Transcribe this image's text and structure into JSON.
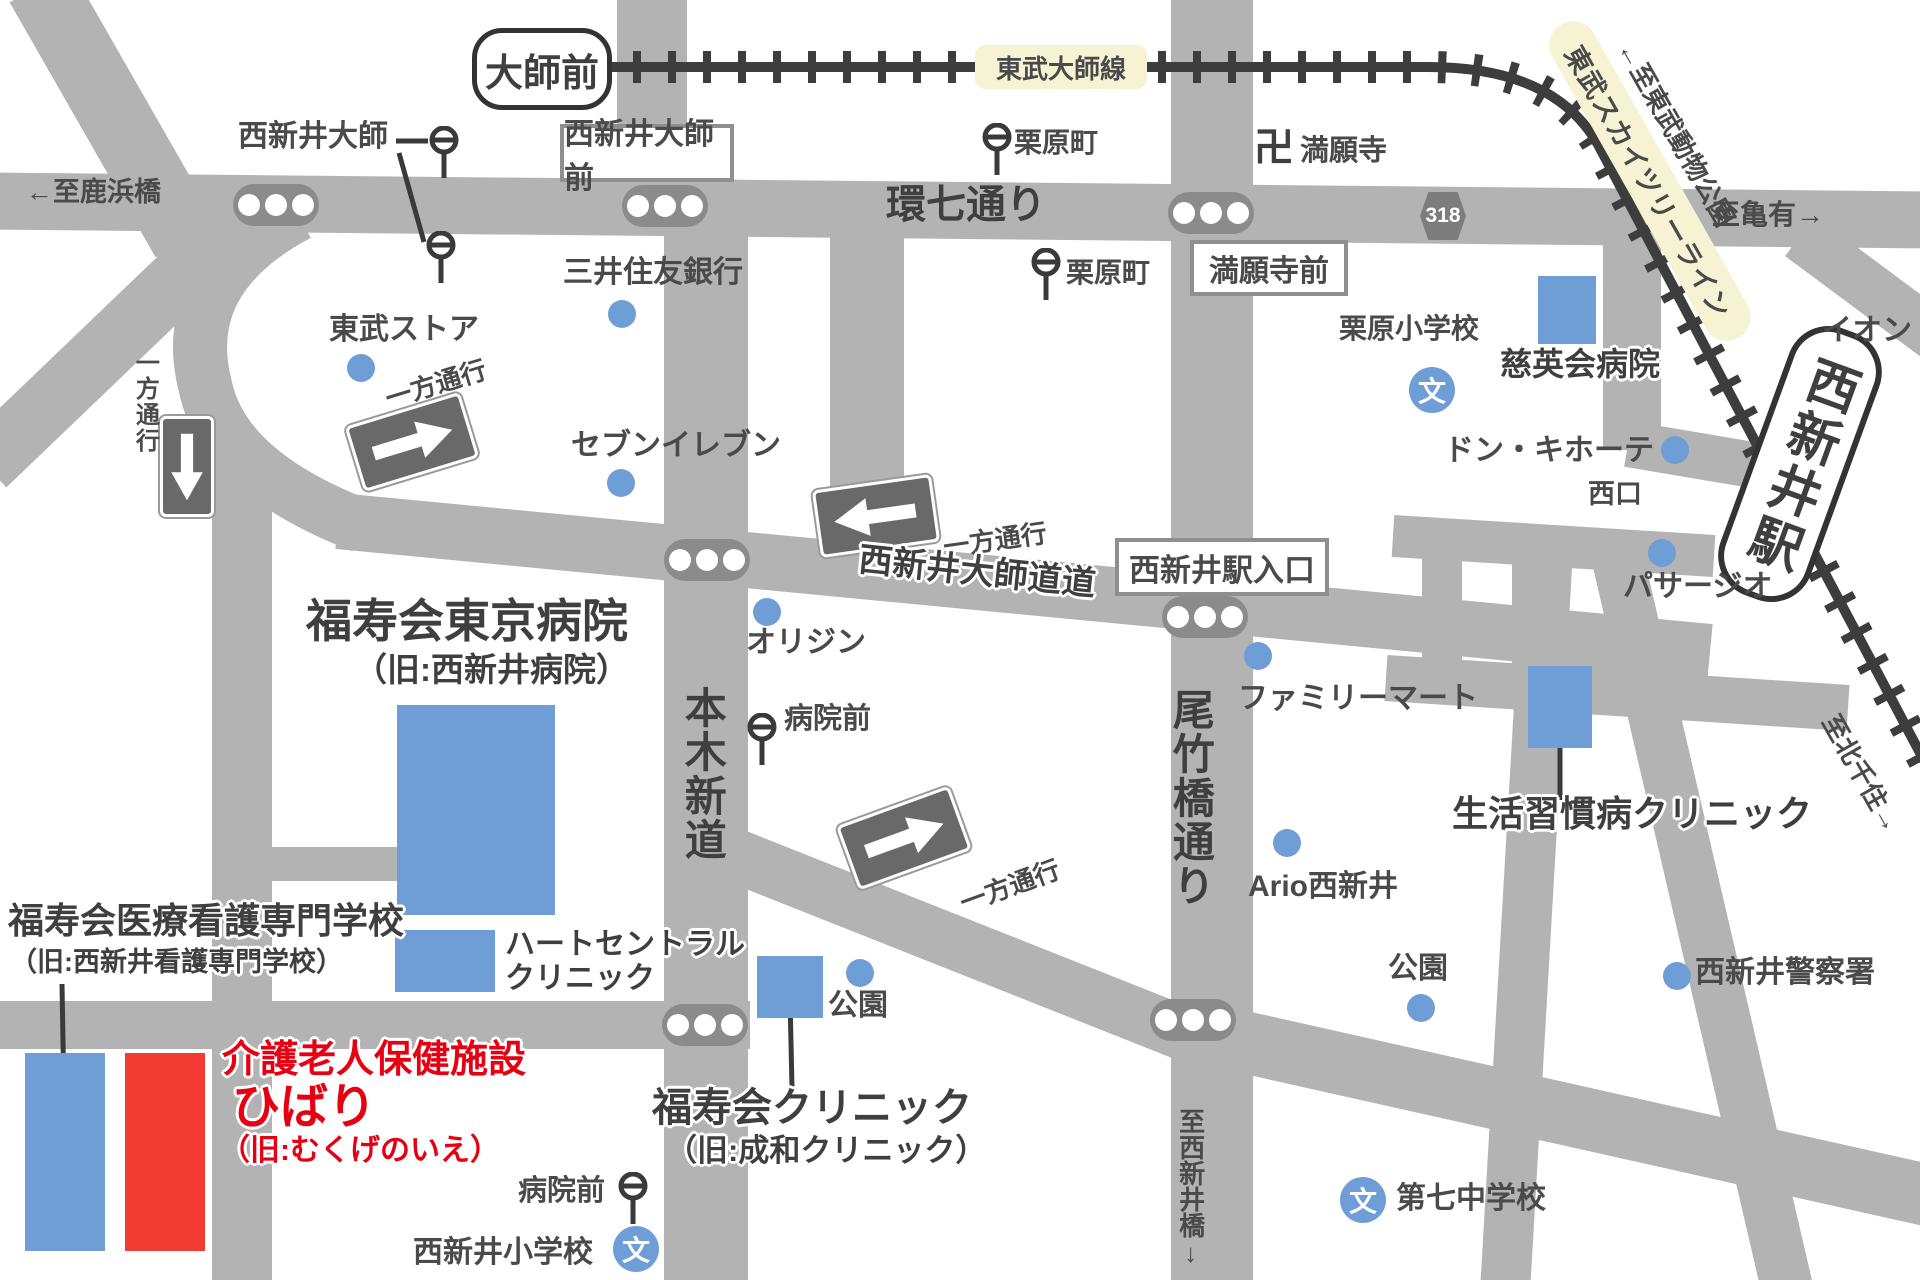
{
  "canvas": {
    "width": 1920,
    "height": 1280
  },
  "colors": {
    "road": "#b3b3b3",
    "signal_pill": "#8b8b8b",
    "rail": "#3d3d3d",
    "ink": "#4a4a4a",
    "ink_dark": "#3f3f3f",
    "blue_marker": "#6f9ed6",
    "red_fill": "#f23b33",
    "red_text": "#e60012",
    "line_highlight": "#f6f3d4",
    "sign_gray": "#696969",
    "box_border": "#8f8f8f",
    "white": "#ffffff"
  },
  "stations": {
    "daishimae": "大師前",
    "nishiarai": "西新井駅",
    "nishiguchi": "西口"
  },
  "rail": {
    "daishi_line": "東武大師線",
    "skytree_line": "東武スカイツリーライン"
  },
  "directions": {
    "to_shikahama": "←至鹿浜橋",
    "to_kameari": "至亀有→",
    "to_tobu_zoo": "←至東武動物公園",
    "to_kitasenju": "至北千住→",
    "to_nishiaraibashi": "至西新井橋↓"
  },
  "roads": {
    "kannana": "環七通り",
    "daishido": "西新井大師道道",
    "motoki": "本木新道",
    "otakebashi": "尾竹橋通り",
    "route318": "318",
    "one_way": "一方通行"
  },
  "intersections": {
    "nishiarai_daishimae": "西新井大師前",
    "mangangi_mae": "満願寺前",
    "eki_iriguchi": "西新井駅入口"
  },
  "bus": {
    "kurihara": "栗原町",
    "byoin": "病院前",
    "daishi": "西新井大師"
  },
  "places": {
    "manganji_mark": "卍",
    "manganji": "満願寺",
    "school_mark": "文",
    "kurihara_es": "栗原小学校",
    "nishiarai_es": "西新井小学校",
    "daishichi_jhs": "第七中学校",
    "tobu_store": "東武ストア",
    "smbc": "三井住友銀行",
    "seven_eleven": "セブンイレブン",
    "origin": "オリジン",
    "family_mart": "ファミリーマート",
    "ario": "Ario西新井",
    "don_quijote": "ドン・キホーテ",
    "ion": "イオン",
    "passaggio": "パサージオ",
    "police": "西新井警察署",
    "park": "公園"
  },
  "facilities": {
    "tokyo_hospital": {
      "name": "福寿会東京病院",
      "former": "（旧:西新井病院）"
    },
    "jieikai": "慈英会病院",
    "seikatsu": "生活習慣病クリニック",
    "heart": {
      "line1": "ハートセントラル",
      "line2": "クリニック"
    },
    "fukujukai_clinic": {
      "name": "福寿会クリニック",
      "former": "（旧:成和クリニック）"
    },
    "nursing": {
      "name": "福寿会医療看護専門学校",
      "former": "（旧:西新井看護専門学校）"
    },
    "hibari": {
      "type": "介護老人保健施設",
      "name": "ひばり",
      "former": "（旧:むくげのいえ）"
    }
  },
  "icons": {
    "traffic_signal": "traffic-signal-icon",
    "bus_stop": "bus-stop-icon",
    "school": "school-icon",
    "one_way_arrow": "one-way-arrow-icon",
    "temple": "temple-icon"
  }
}
